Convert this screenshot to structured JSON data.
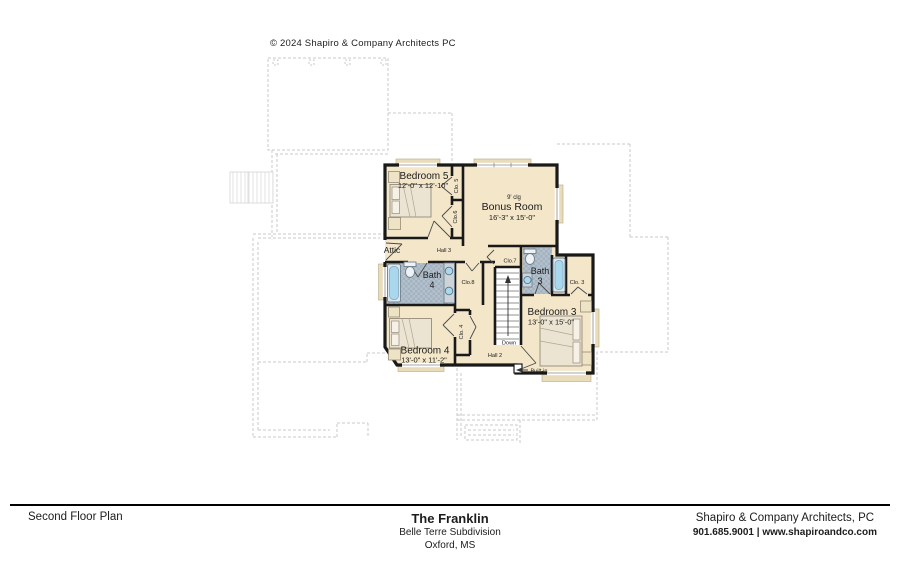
{
  "copyright": "© 2024 Shapiro & Company Architects PC",
  "plan": {
    "rooms": {
      "bedroom5": {
        "name": "Bedroom 5",
        "dims": "12'-0\" x 12'-10\""
      },
      "bonus": {
        "clg": "9' clg",
        "name": "Bonus Room",
        "dims": "16'-3\" x 15'-0\""
      },
      "bedroom3": {
        "name": "Bedroom 3",
        "dims": "13'-0\" x 15'-0\""
      },
      "bedroom4": {
        "name": "Bedroom 4",
        "dims": "13'-0\" x 11'-2\""
      },
      "bath4": {
        "line1": "Bath",
        "line2": "4"
      },
      "bath3": {
        "line1": "Bath",
        "line2": "3"
      }
    },
    "labels": {
      "attic": "Attic",
      "hall3": "Hall 3",
      "hall2": "Hall 2",
      "clo5": "Clo. 5",
      "clo6": "Clo.6",
      "clo7": "Clo.7",
      "clo8": "Clo.8",
      "clo3": "Clo. 3",
      "clo4": "Clo. 4",
      "down": "Down",
      "builtin": "Built-in"
    }
  },
  "titleblock": {
    "sheet_title": "Second Floor Plan",
    "plan_name": "The Franklin",
    "subdivision": "Belle Terre Subdivision",
    "location": "Oxford, MS",
    "firm": "Shapiro & Company Architects, PC",
    "contact": "901.685.9001 | www.shapiroandco.com"
  },
  "colors": {
    "floor_tan": "#f3e6c9",
    "tile_blue_gray": "#b0bec9",
    "wall_black": "#191919",
    "roofline_gray": "#c9c9c9",
    "tub_blue": "#a9d7ee"
  }
}
